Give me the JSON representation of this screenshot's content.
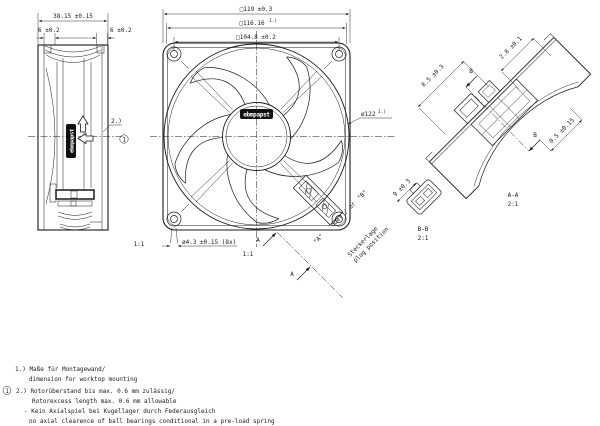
{
  "page": {
    "background": "#ffffff",
    "line_color": "#1a1a1a"
  },
  "side_view": {
    "scale_label": "1:1",
    "logo": "ebmpapst",
    "dim_depth": "38.15 ±0.15",
    "dim_flange_front": "6 ±0.2",
    "dim_flange_rear": "6 ±0.2",
    "note_ref": "2.)",
    "balloon": "1"
  },
  "front_view": {
    "scale_label": "1:1",
    "logo": "ebmpapst",
    "dim_frame": "□119 ±0.3",
    "dim_corner": "□116.16",
    "dim_corner_ref": "1.)",
    "dim_holes_pitch": "□104.8 ±0.2",
    "dim_impeller": "ø122",
    "dim_impeller_ref": "1.)",
    "dim_mounting_holes": "ø4.3 ±0.15 (8x)",
    "section_a_label": "A",
    "plug_variant_a": "\"A\"",
    "plug_variant_or": "oder / or",
    "plug_variant_b": "\"B\"",
    "plug_position_de": "Steckerlage",
    "plug_position_en": "plug position"
  },
  "section_aa": {
    "label": "A-A",
    "scale": "2:1",
    "dim_depth": "8.5 ±0.3",
    "dim_plug": "2.8 ±0.1",
    "dim_lip": "0.5 ±0.15",
    "arrow_label": "B"
  },
  "section_bb": {
    "label": "B-B",
    "scale": "2:1",
    "dim_width": "9 ±0.3"
  },
  "notes": {
    "ref1_de": "1.) Maße für Montagewand/",
    "ref1_en": "dimension for worktop mounting",
    "balloon": "1",
    "ref2_de": "2.) Rotorüberstand bis max. 0.6 mm zulässig/",
    "ref2_en": "Rotorexcess length max. 0.6 mm allowable",
    "note3_de": "- Kein Axialspiel bei Kugellager durch Federausgleich",
    "note3_en": "no axial clearence of ball bearings conditional in a pre-load spring"
  }
}
